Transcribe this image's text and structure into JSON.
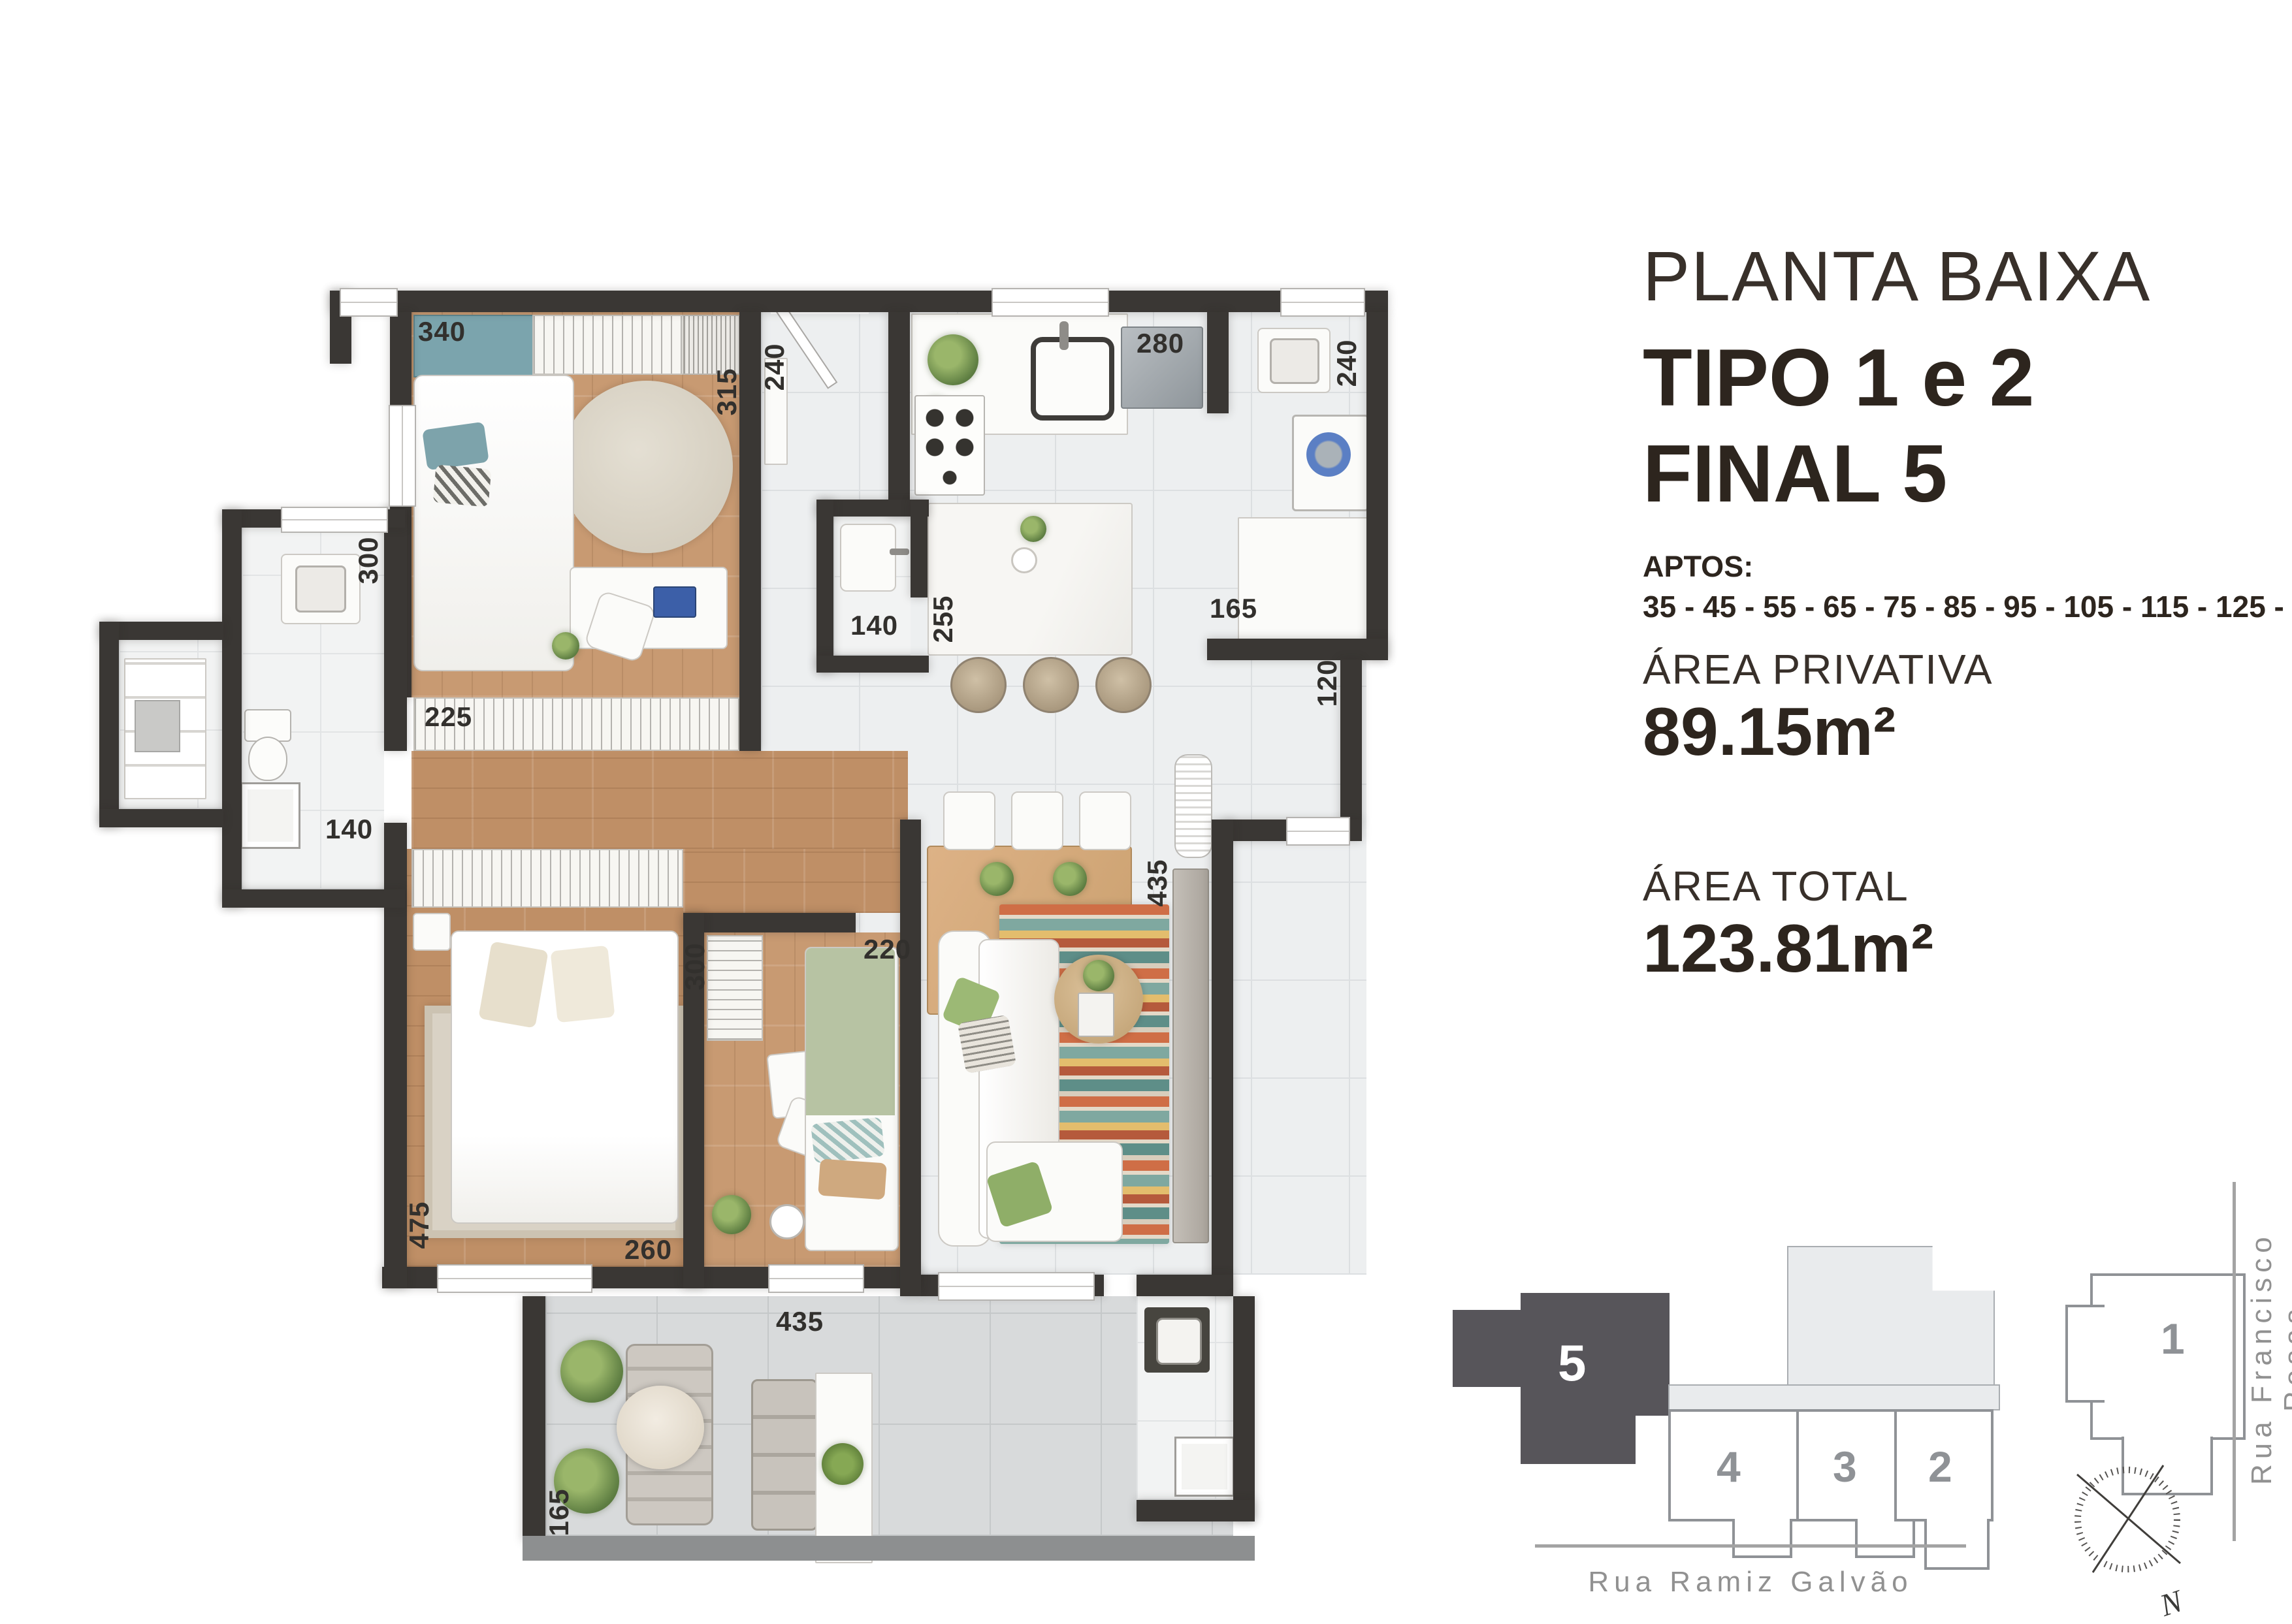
{
  "info": {
    "title": "PLANTA BAIXA",
    "type_line": "TIPO 1 e 2",
    "final_line": "FINAL 5",
    "aptos_label": "APTOS:",
    "aptos_numbers": "35 - 45 - 55 - 65 - 75 - 85 - 95 - 105 - 115 - 125 - 135",
    "area_privativa_label": "ÁREA PRIVATIVA",
    "area_privativa_value": "89.15m²",
    "area_total_label": "ÁREA TOTAL",
    "area_total_value": "123.81m²"
  },
  "measurements": [
    {
      "text": "340"
    },
    {
      "text": "315"
    },
    {
      "text": "240"
    },
    {
      "text": "280"
    },
    {
      "text": "240"
    },
    {
      "text": "300"
    },
    {
      "text": "225"
    },
    {
      "text": "140"
    },
    {
      "text": "255"
    },
    {
      "text": "165"
    },
    {
      "text": "120"
    },
    {
      "text": "140"
    },
    {
      "text": "300"
    },
    {
      "text": "220"
    },
    {
      "text": "475"
    },
    {
      "text": "260"
    },
    {
      "text": "435"
    },
    {
      "text": "435"
    },
    {
      "text": "165"
    }
  ],
  "keyplan": {
    "units": [
      {
        "label": "5",
        "highlighted": true
      },
      {
        "label": "4",
        "highlighted": false
      },
      {
        "label": "3",
        "highlighted": false
      },
      {
        "label": "2",
        "highlighted": false
      },
      {
        "label": "1",
        "highlighted": false
      }
    ],
    "street_bottom": "Rua Ramiz Galvão",
    "street_right": "Rua Francisco Rosas",
    "compass_label": "N"
  },
  "colors": {
    "wall": "#3a3734",
    "balcony_wall": "#8d8f90",
    "wood_floor": "#bf8f66",
    "tile_floor": "#edeff0",
    "teal_accent": "#7ba4ad",
    "green_bed": "#b7c3a3",
    "keyplan_dark_unit": "#57555a",
    "keyplan_outline": "#8f9296",
    "rug_stripes": [
      "#cf6e46",
      "#7fa8a0",
      "#e3bd6d",
      "#b55a3c",
      "#5e8e88",
      "#e4d9c8"
    ]
  }
}
